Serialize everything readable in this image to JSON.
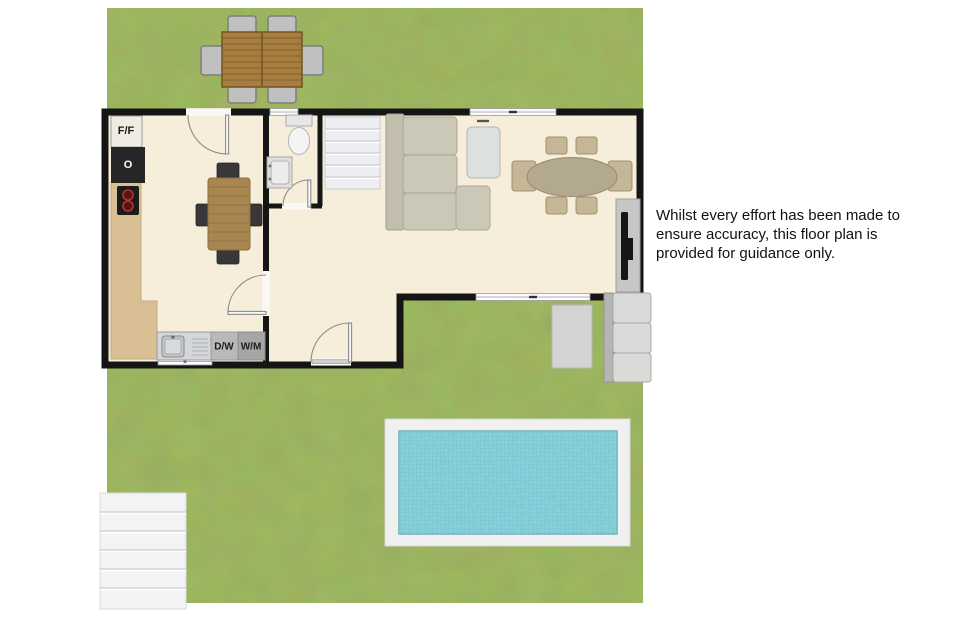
{
  "labels": {
    "fridge_freezer": "F/F",
    "oven": "O",
    "dishwasher": "D/W",
    "washing_machine": "W/M"
  },
  "disclaimer": {
    "lines": [
      "Whilst every effort has been made to",
      "ensure accuracy, this floor plan is",
      "provided for guidance only."
    ]
  },
  "colors": {
    "grass": "#7d9b49",
    "floor": "#f6eedb",
    "wall": "#151515",
    "pool_water": "#57bfcd",
    "pool_deck": "#f0f0f0",
    "wood_indoor": "#a8864f",
    "wood_outdoor": "#a87e3f",
    "counter": "#d8bf94",
    "sofa": "#ccc8b8",
    "stairs": "#eceef2",
    "appliance_grey": "#b9b9b9"
  }
}
